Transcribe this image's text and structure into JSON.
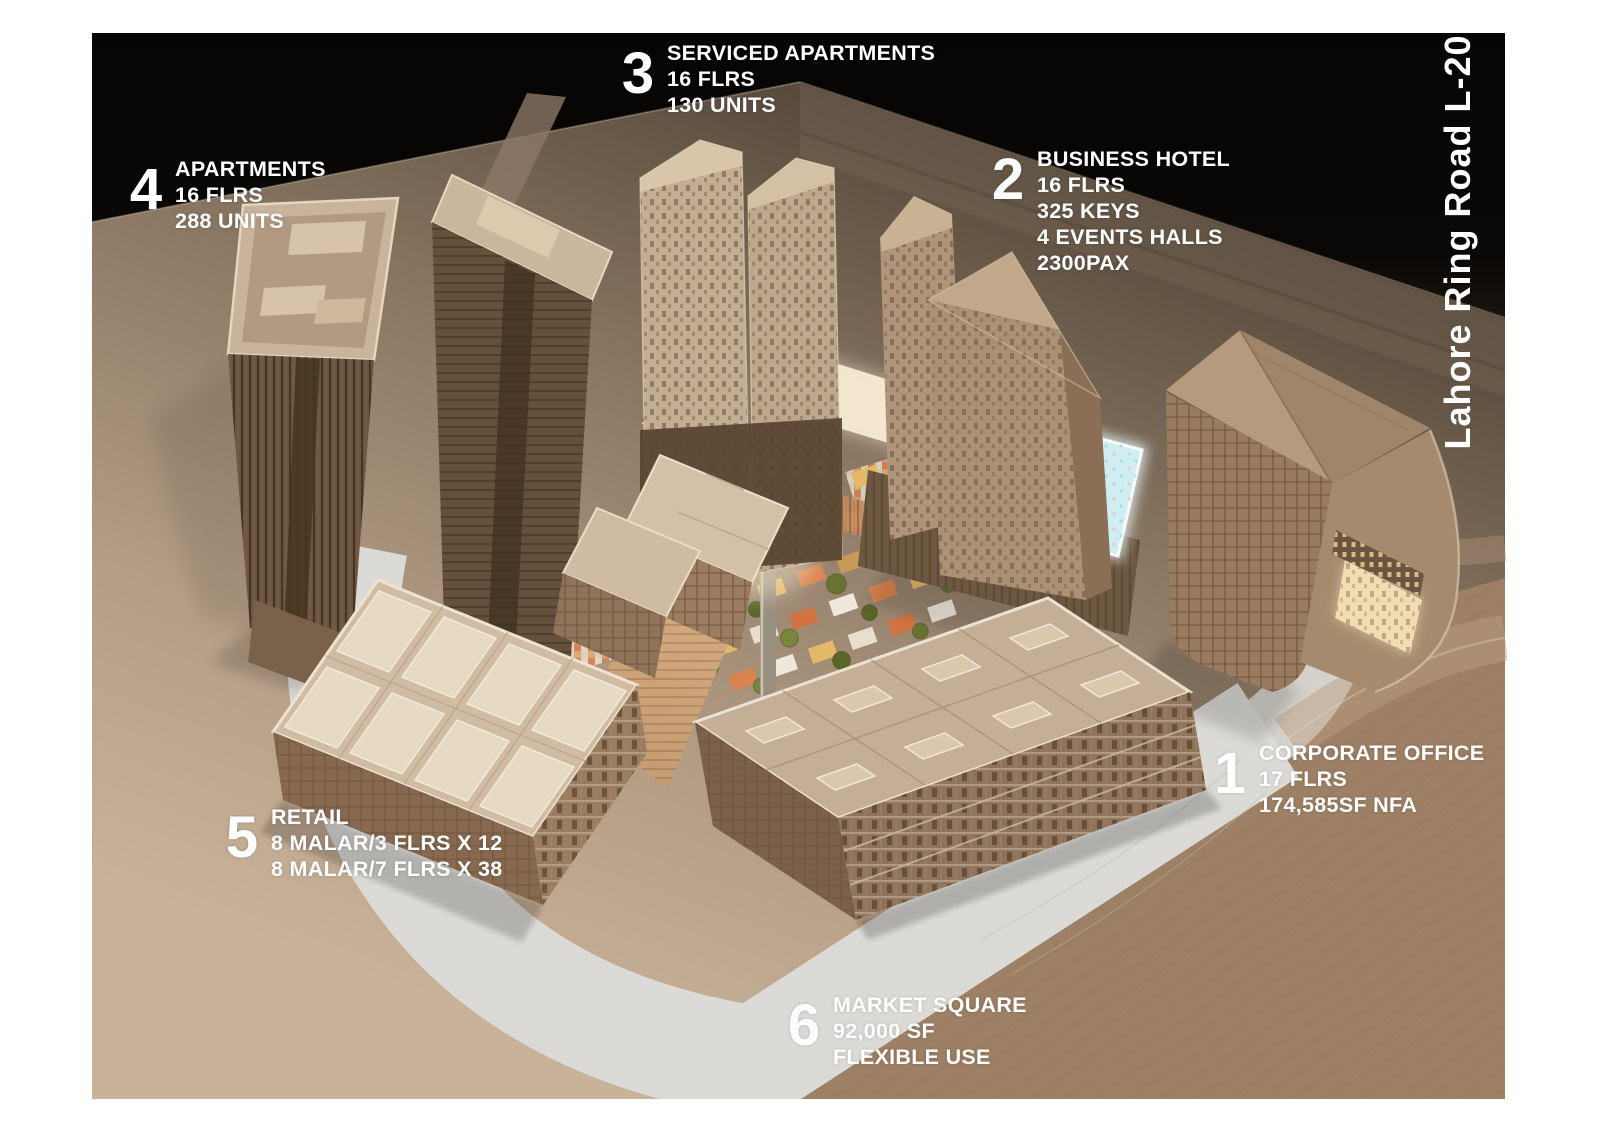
{
  "image_type": "architectural-masterplan-annotated-model",
  "road_label": "Lahore Ring Road L-20",
  "annotations": [
    {
      "number": "1",
      "title": "CORPORATE OFFICE",
      "lines": [
        "17 FLRS",
        "174,585SF NFA"
      ]
    },
    {
      "number": "2",
      "title": "BUSINESS HOTEL",
      "lines": [
        "16 FLRS",
        "325 KEYS",
        "4 EVENTS HALLS",
        "2300PAX"
      ]
    },
    {
      "number": "3",
      "title": "SERVICED APARTMENTS",
      "lines": [
        "16 FLRS",
        "130 UNITS"
      ]
    },
    {
      "number": "4",
      "title": "APARTMENTS",
      "lines": [
        "16 FLRS",
        "288 UNITS"
      ]
    },
    {
      "number": "5",
      "title": "RETAIL",
      "lines": [
        "8 MALAR/3 FLRS X 12",
        "8 MALAR/7 FLRS X 38"
      ]
    },
    {
      "number": "6",
      "title": "MARKET SQUARE",
      "lines": [
        "92,000 SF",
        "FLEXIBLE USE"
      ]
    }
  ],
  "colors": {
    "page_background": "#ffffff",
    "sky": "#070604",
    "ground_light_tan": "#c6b098",
    "ground_wood_brown": "#a3866a",
    "white_road": "#dcdad6",
    "pool_glass": "#cfeef2",
    "glow_cream": "#f6ead2",
    "label_text": "#ffffff"
  }
}
